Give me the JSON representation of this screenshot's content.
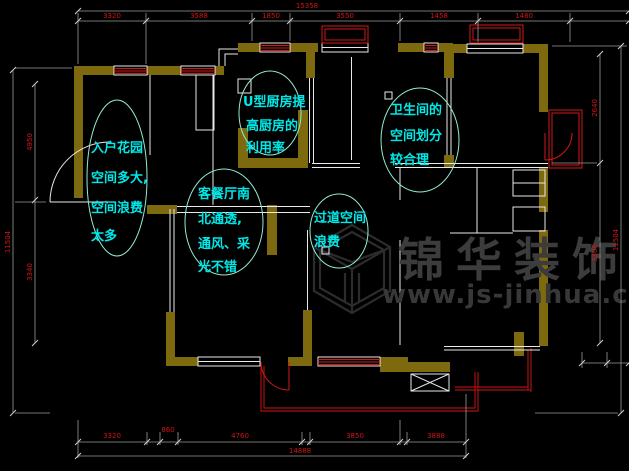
{
  "meta": {
    "type": "cad-floor-plan-screenshot",
    "width": 629,
    "height": 471
  },
  "colors": {
    "background": "#000000",
    "wall": "#7d690e",
    "thin_wall": "#e9e9e9",
    "window_red": "#d01818",
    "balcony_red": "#a81212",
    "dimension_line": "#9a9a9a",
    "dimension_text": "#d01616",
    "annotation_text": "#00e8e8",
    "annotation_ellipse": "#93ecd4",
    "watermark": "#3c3c3c"
  },
  "watermark": {
    "brand": "锦华装饰",
    "url": "www.js-jinhua.com",
    "logo": "isometric-cube"
  },
  "annotations": {
    "entry_garden": {
      "lines": [
        "入户花园",
        "空间多大,",
        "空间浪费",
        "太多"
      ]
    },
    "kitchen": {
      "lines": [
        "U型厨房提",
        "高厨房的",
        "利用率"
      ]
    },
    "bathroom": {
      "lines": [
        "卫生间的",
        "空间划分",
        "较合理"
      ]
    },
    "living_dining": {
      "lines": [
        "客餐厅南",
        "北通透,",
        "通风、采",
        "光不错"
      ]
    },
    "corridor": {
      "lines": [
        "过道空间",
        "浪费"
      ]
    }
  },
  "dimensions": {
    "top": {
      "overall": "15358",
      "segments": [
        "3320",
        "3588",
        "1850",
        "3550",
        "1458",
        "1480"
      ]
    },
    "bottom": {
      "overall": "14888",
      "segments": [
        "3320",
        "860",
        "4760",
        "3850",
        "3888"
      ]
    },
    "left": {
      "overall": "11504",
      "segments": [
        "4950",
        "3340"
      ]
    },
    "right": {
      "overall": "11504",
      "segments": [
        "2640",
        "3300"
      ]
    }
  }
}
